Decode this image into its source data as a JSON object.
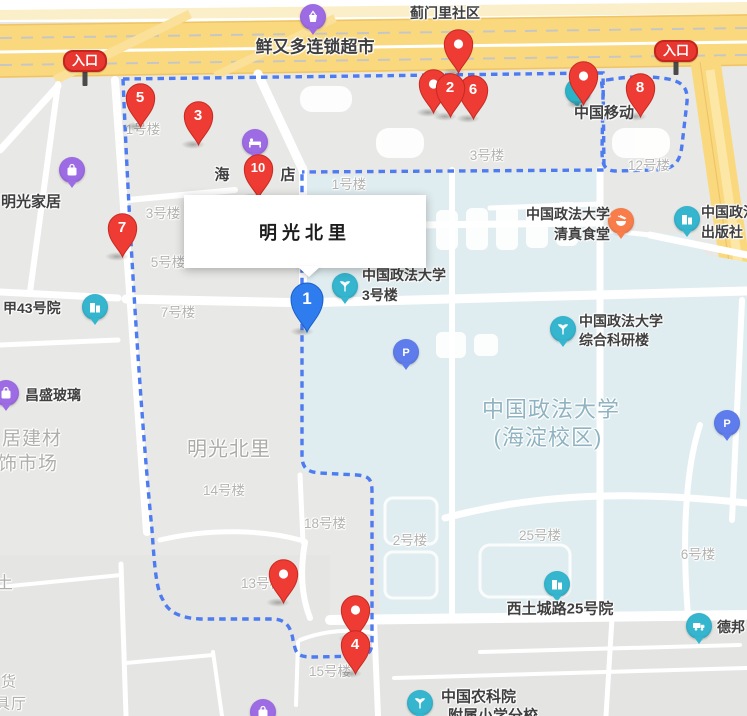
{
  "map": {
    "infobox": {
      "title": "明光北里",
      "x": 184,
      "y": 195,
      "w": 242,
      "h": 73,
      "pointer_x": 297,
      "pointer_y": 266
    },
    "colors": {
      "marker_red": "#EE3B33",
      "marker_red_dark": "#C62A22",
      "marker_blue": "#2E7CEE",
      "marker_blue_dark": "#1B5FC9",
      "boundary_blue": "#4D7BF0",
      "road_yellow": "#FAD97E",
      "road_yellow_light": "#FCE7A6",
      "campus_fill": "#E0EDF0",
      "block_gray": "#E8E8E6",
      "poi_teal": "#35B5CE",
      "poi_purple": "#9D6BE3",
      "poi_orange": "#F87D4B",
      "poi_parking": "#5E7CEB",
      "poi_text": "#3F3F3F",
      "bldg_label": "#B3B3B1",
      "area_label": "#ABABA9",
      "campus_label": "#8FB3C0"
    },
    "entrances": [
      {
        "label": "入口",
        "x": 85,
        "y": 60,
        "pole_h": 16
      },
      {
        "label": "入口",
        "x": 676,
        "y": 50,
        "pole_h": 15
      }
    ],
    "building_labels": [
      {
        "text": "1号楼",
        "x": 143,
        "y": 128
      },
      {
        "text": "3号楼",
        "x": 163,
        "y": 212
      },
      {
        "text": "5号楼",
        "x": 168,
        "y": 261
      },
      {
        "text": "7号楼",
        "x": 178,
        "y": 311
      },
      {
        "text": "1号楼",
        "x": 349,
        "y": 183
      },
      {
        "text": "3号楼",
        "x": 487,
        "y": 154
      },
      {
        "text": "12号楼",
        "x": 649,
        "y": 164
      },
      {
        "text": "14号楼",
        "x": 224,
        "y": 489
      },
      {
        "text": "18号楼",
        "x": 325,
        "y": 522
      },
      {
        "text": "13号楼",
        "x": 262,
        "y": 582
      },
      {
        "text": "15号楼",
        "x": 330,
        "y": 670
      },
      {
        "text": "2号楼",
        "x": 410,
        "y": 539
      },
      {
        "text": "25号楼",
        "x": 540,
        "y": 534
      },
      {
        "text": "6号楼",
        "x": 698,
        "y": 553
      }
    ],
    "area_labels": [
      {
        "text": "明光北里",
        "x": 229,
        "y": 447,
        "size": 20,
        "color": "#ABABA9"
      },
      {
        "text": "中国政法大学",
        "x": 551,
        "y": 408,
        "size": 22,
        "color": "#8FB3C0"
      },
      {
        "text": "(海淀校区)",
        "x": 548,
        "y": 436,
        "size": 22,
        "color": "#8FB3C0"
      },
      {
        "text": "居建材",
        "x": 32,
        "y": 437,
        "size": 19,
        "color": "#AFAFAD"
      },
      {
        "text": "饰市场",
        "x": 28,
        "y": 462,
        "size": 19,
        "color": "#AFAFAD"
      },
      {
        "text": "土",
        "x": 5,
        "y": 581,
        "size": 17,
        "color": "#AFAFAD"
      },
      {
        "text": "货",
        "x": 9,
        "y": 681,
        "size": 15,
        "color": "#AFAFAD"
      },
      {
        "text": "具厅",
        "x": 11,
        "y": 703,
        "size": 15,
        "color": "#AFAFAD"
      }
    ],
    "pois": [
      {
        "name": "jimenli-community",
        "lines": [
          {
            "text": "蓟门里社区",
            "x": 445,
            "y": 13,
            "align": "center",
            "size": 14
          }
        ]
      },
      {
        "name": "xianyouduo-supermarket",
        "icon": "basket-icon",
        "icon_color": "#9D6BE3",
        "ix": 313,
        "iy": 17,
        "lines": [
          {
            "text": "鲜又多连锁超市",
            "x": 315,
            "y": 45,
            "align": "center",
            "size": 17
          }
        ]
      },
      {
        "name": "hotel",
        "icon": "bed-icon",
        "icon_color": "#9D6BE3",
        "ix": 255,
        "iy": 142,
        "lines": [
          {
            "text": "海",
            "x": 222,
            "y": 174,
            "align": "center",
            "size": 15
          },
          {
            "text": "店",
            "x": 288,
            "y": 174,
            "align": "center",
            "size": 15
          }
        ]
      },
      {
        "name": "china-mobile",
        "icon": "mobile-icon",
        "icon_color": "#2BB3C8",
        "ix": 578,
        "iy": 91,
        "lines": [
          {
            "text": "中国移动",
            "x": 604,
            "y": 112,
            "align": "center",
            "size": 15
          }
        ]
      },
      {
        "name": "mingguang-furniture",
        "icon": "bag-icon",
        "icon_color": "#9D6BE3",
        "ix": 72,
        "iy": 170,
        "lines": [
          {
            "text": "明光家居",
            "x": 31,
            "y": 201,
            "align": "center",
            "size": 15
          }
        ]
      },
      {
        "name": "jia-43-yard",
        "icon": "building-icon",
        "icon_color": "#35B5CE",
        "ix": 95,
        "iy": 307,
        "lines": [
          {
            "text": "甲43号院",
            "x": 3,
            "y": 308,
            "align": "left",
            "size": 14
          }
        ]
      },
      {
        "name": "cupl-building-3",
        "icon": "sprout-icon",
        "icon_color": "#35B5CE",
        "ix": 345,
        "iy": 286,
        "lines": [
          {
            "text": "中国政法大学",
            "x": 362,
            "y": 275,
            "align": "left",
            "size": 14
          },
          {
            "text": "3号楼",
            "x": 362,
            "y": 295,
            "align": "left",
            "size": 14
          }
        ]
      },
      {
        "name": "cupl-halal-canteen",
        "icon": "bowl-icon",
        "icon_color": "#F87D4B",
        "ix": 621,
        "iy": 221,
        "lines": [
          {
            "text": "中国政法大学",
            "x": 610,
            "y": 214,
            "align": "right",
            "size": 14
          },
          {
            "text": "清真食堂",
            "x": 610,
            "y": 234,
            "align": "right",
            "size": 14
          }
        ]
      },
      {
        "name": "cupl-press",
        "icon": "building-icon",
        "icon_color": "#35B5CE",
        "ix": 687,
        "iy": 219,
        "lines": [
          {
            "text": "中国政法大学",
            "x": 701,
            "y": 212,
            "align": "left",
            "size": 14
          },
          {
            "text": "出版社",
            "x": 701,
            "y": 232,
            "align": "left",
            "size": 14
          }
        ]
      },
      {
        "name": "cupl-research-building",
        "icon": "sprout-icon",
        "icon_color": "#35B5CE",
        "ix": 563,
        "iy": 329,
        "lines": [
          {
            "text": "中国政法大学",
            "x": 579,
            "y": 321,
            "align": "left",
            "size": 14
          },
          {
            "text": "综合科研楼",
            "x": 579,
            "y": 340,
            "align": "left",
            "size": 14
          }
        ]
      },
      {
        "name": "parking-1",
        "icon": "parking-icon",
        "icon_color": "#5E7CEB",
        "ix": 406,
        "iy": 352,
        "lines": []
      },
      {
        "name": "parking-2",
        "icon": "parking-icon",
        "icon_color": "#5E7CEB",
        "ix": 727,
        "iy": 423,
        "lines": []
      },
      {
        "name": "xitucheng-road-25-yard",
        "icon": "building-icon",
        "icon_color": "#35B5CE",
        "ix": 557,
        "iy": 584,
        "lines": [
          {
            "text": "西土城路25号院",
            "x": 560,
            "y": 608,
            "align": "center",
            "size": 15
          }
        ]
      },
      {
        "name": "debang-logistics",
        "icon": "truck-icon",
        "icon_color": "#35B5CE",
        "ix": 699,
        "iy": 626,
        "lines": [
          {
            "text": "德邦",
            "x": 717,
            "y": 627,
            "align": "left",
            "size": 14
          }
        ]
      },
      {
        "name": "cas-agriculture-academy",
        "icon": "sprout-icon",
        "icon_color": "#35B5CE",
        "ix": 420,
        "iy": 703,
        "lines": [
          {
            "text": "中国农科院",
            "x": 441,
            "y": 696,
            "align": "left",
            "size": 15
          },
          {
            "text": "附属小学分校",
            "x": 448,
            "y": 715,
            "align": "left",
            "size": 15
          }
        ]
      },
      {
        "name": "changsheng-glass",
        "icon": "bag-icon",
        "icon_color": "#9D6BE3",
        "ix": 6,
        "iy": 393,
        "lines": [
          {
            "text": "昌盛玻璃",
            "x": 25,
            "y": 395,
            "align": "left",
            "size": 14
          }
        ]
      },
      {
        "name": "purple-poi-bottom",
        "icon": "bag-icon",
        "icon_color": "#9D6BE3",
        "ix": 263,
        "iy": 712,
        "lines": []
      }
    ],
    "markers": [
      {
        "id": "pin-plain-north",
        "type": "red-plain",
        "label": "",
        "x": 458,
        "y": 44
      },
      {
        "id": "pin-plain-hidden",
        "type": "red-plain",
        "label": "",
        "x": 433,
        "y": 84
      },
      {
        "id": "pin-6",
        "type": "red",
        "label": "6",
        "x": 473,
        "y": 90
      },
      {
        "id": "pin-2",
        "type": "red",
        "label": "2",
        "x": 450,
        "y": 88
      },
      {
        "id": "pin-5",
        "type": "red",
        "label": "5",
        "x": 140,
        "y": 98
      },
      {
        "id": "pin-3",
        "type": "red",
        "label": "3",
        "x": 198,
        "y": 116
      },
      {
        "id": "pin-10",
        "type": "red",
        "label": "10",
        "x": 258,
        "y": 169
      },
      {
        "id": "pin-7",
        "type": "red",
        "label": "7",
        "x": 122,
        "y": 228
      },
      {
        "id": "pin-plain-mobile",
        "type": "red-plain",
        "label": "",
        "x": 583,
        "y": 76
      },
      {
        "id": "pin-8",
        "type": "red",
        "label": "8",
        "x": 640,
        "y": 88
      },
      {
        "id": "pin-plain-bldg13",
        "type": "red-plain",
        "label": "",
        "x": 283,
        "y": 574
      },
      {
        "id": "pin-plain-bldg15",
        "type": "red-plain",
        "label": "",
        "x": 355,
        "y": 610
      },
      {
        "id": "pin-4",
        "type": "red",
        "label": "4",
        "x": 355,
        "y": 645
      },
      {
        "id": "pin-1",
        "type": "blue",
        "label": "1",
        "x": 307,
        "y": 299
      }
    ]
  }
}
